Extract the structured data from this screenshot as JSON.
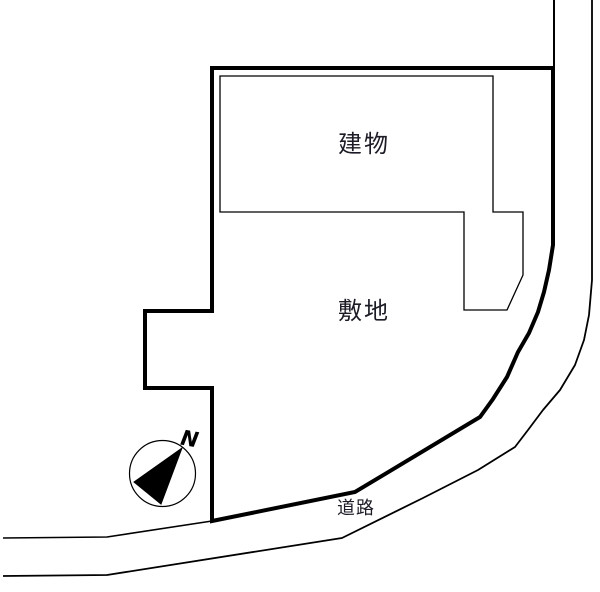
{
  "diagram": {
    "type": "site-plan",
    "background_color": "#ffffff",
    "line_color": "#000000",
    "text_color": "#1c1c26",
    "labels": {
      "building": "建物",
      "site": "敷地",
      "road": "道路"
    },
    "compass": {
      "north_label": "N",
      "needle_direction": "upper-right"
    }
  }
}
